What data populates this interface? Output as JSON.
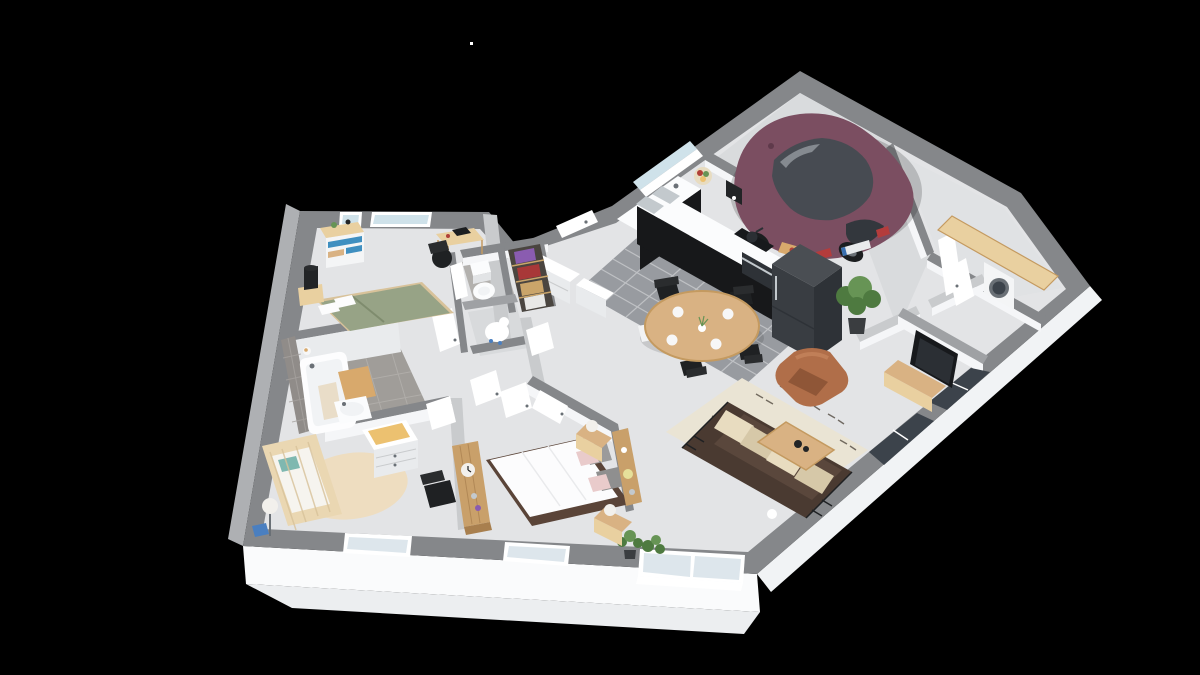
{
  "scene": {
    "type": "3d-floor-plan-isometric-render",
    "background": "#000000",
    "rooms": [
      {
        "name": "garage",
        "furniture": [
          "hatchback-car"
        ]
      },
      {
        "name": "kitchen",
        "furniture": [
          "l-shaped-black-counter",
          "double-sink",
          "cooktop-with-pan",
          "oven",
          "refrigerator",
          "coffee-maker",
          "fruit-bowl",
          "cutting-board",
          "window-over-sink"
        ]
      },
      {
        "name": "dining-area",
        "furniture": [
          "round-wood-table",
          "black-metal-chairs-x4",
          "white-chair",
          "plates-and-vase"
        ]
      },
      {
        "name": "living-room",
        "furniture": [
          "dark-sofa-with-cream-cushions",
          "leather-armchair",
          "wood-coffee-table",
          "patterned-rug",
          "tv",
          "tv-stand",
          "potted-plants"
        ]
      },
      {
        "name": "laundry-room",
        "furniture": [
          "wood-counter",
          "washing-machine"
        ]
      },
      {
        "name": "hallway",
        "furniture": [
          "white-sideboard",
          "potted-plant",
          "interior-doors"
        ]
      },
      {
        "name": "bedroom-1",
        "furniture": [
          "bed-green-duvet",
          "dresser-blue-drawers",
          "desk",
          "desk-chair",
          "nightstand",
          "black-lamp"
        ]
      },
      {
        "name": "bathroom",
        "furniture": [
          "bathtub",
          "washbasin",
          "tan-bath-mat",
          "gray-wall-tiles"
        ]
      },
      {
        "name": "wc",
        "furniture": [
          "toilet"
        ]
      },
      {
        "name": "closet",
        "furniture": [
          "shelves-with-clothes"
        ]
      },
      {
        "name": "storage-nook",
        "furniture": [
          "white-figure"
        ]
      },
      {
        "name": "nursery",
        "furniture": [
          "crib",
          "changing-dresser",
          "round-beige-rug",
          "floor-lamp",
          "blue-stool",
          "black-chair"
        ]
      },
      {
        "name": "master-bedroom",
        "furniture": [
          "double-bed-white-duvet",
          "gray-and-pink-pillows",
          "nightstands-with-lamps",
          "wood-console-with-clock",
          "wall-shelf",
          "plants"
        ]
      }
    ]
  },
  "palette": {
    "bg": "#000000",
    "wall_top": "#85878a",
    "wall_top_mid": "#9fa1a4",
    "wall_top_light": "#c9cbcd",
    "wall_face_white": "#f5f6f8",
    "wall_face_shade": "#e9ebed",
    "ext_face_south": "#fafbfc",
    "ext_face_south2": "#eceef0",
    "ext_face_se": "#f1f3f5",
    "ext_face_west": "#aeb0b3",
    "floor_main": "#e3e4e6",
    "floor_dark": "#d8dadc",
    "floor_garage": "#d9dbdd",
    "floor_laundry": "#e0e2e4",
    "tile_kitchen": "#989ba0",
    "tile_kitchen_line": "#c6c8cb",
    "tile_bath": "#a09d99",
    "tile_bath_line": "#b7b4b0",
    "tile_wc": "#b3b1ae",
    "tile_wall": "#908c89",
    "tile_wall_line": "#a7a3a0",
    "window_glass": "#cfe2ea",
    "window_glass_pale": "#dde6ec",
    "window_frame": "#ffffff",
    "glass_dark": "#3c434b",
    "counter_black": "#17181a",
    "counter_top": "#fbfcfd",
    "steel": "#c3c9cd",
    "steel_dark": "#6a7076",
    "fridge_top": "#4a4e53",
    "fridge_front": "#393d42",
    "fridge_side": "#2e3237",
    "wood_light": "#e9d0a0",
    "wood_mid": "#d9b283",
    "wood_dark": "#c49a60",
    "wood_plank": "#c9a06a",
    "wood_plank_dark": "#a87f4e",
    "car_body": "#7b4e61",
    "car_body_dark": "#5f3a4b",
    "car_glass": "#474b52",
    "car_glass_dark": "#33373d",
    "tire": "#1c1e20",
    "taillight": "#b43c3c",
    "plate_white": "#e8eaec",
    "plate_blue": "#3a6fb0",
    "plate_white2": "#f7f7f7",
    "chair_black": "#1f2123",
    "chair_black2": "#2a2c2e",
    "chair_white": "#f2f3f4",
    "sofa_frame": "#4a3a31",
    "sofa_seat": "#5a473c",
    "cushion_cream": "#e8dcc0",
    "cushion_cream_dark": "#d6c8a8",
    "armchair": "#b06e49",
    "armchair_dark": "#8f5637",
    "armchair_light": "#c07f58",
    "rug_cream": "#eae4d4",
    "rug_pattern": "#4a4238",
    "tv_black": "#17191c",
    "tv_screen": "#2b2f34",
    "bed_green": "#97a386",
    "bed_green_dark": "#7f8c6e",
    "duvet_white": "#fcfcfd",
    "duvet_shade": "#e9eaec",
    "pillow_gray": "#9b9b9b",
    "pillow_gray2": "#8f8f8f",
    "pillow_pink": "#e9cbcb",
    "bedframe_dark": "#5a4438",
    "crib_wood": "#ead7b2",
    "crib_wood_dark": "#d8c29a",
    "mattress": "#f6f4ef",
    "teal": "#7fb8b0",
    "rug_round": "#eeddc0",
    "pad_tan": "#ecc170",
    "mat_tan": "#d8a96c",
    "tub_white": "#fdfdfe",
    "tub_shade": "#dfe2e5",
    "tub_inner": "#f1f3f5",
    "towel_tan": "#e9ddc8",
    "toilet_white": "#fbfcfd",
    "toilet_shade": "#e2e4e6",
    "plant_green": "#4e7a40",
    "plant_green_light": "#679455",
    "pot_dark": "#3a3d40",
    "lamp_black": "#222426",
    "closet_bg": "#4a4540",
    "closet_red": "#a83838",
    "closet_purple": "#8a5cb0",
    "closet_tan": "#caa56a",
    "closet_white": "#e8e8e6",
    "blue_drawer": "#3f8fc0",
    "stool_blue": "#4a7fc0",
    "lamp_yellow": "#e6e09a",
    "lamp_white": "#f2f0ec",
    "food_red": "#b04038",
    "white": "#ffffff",
    "near_white": "#f4f5f6",
    "shadow": "#000000"
  },
  "artifacts": {
    "stray_pixel": {
      "x": 470,
      "y": 42
    }
  }
}
